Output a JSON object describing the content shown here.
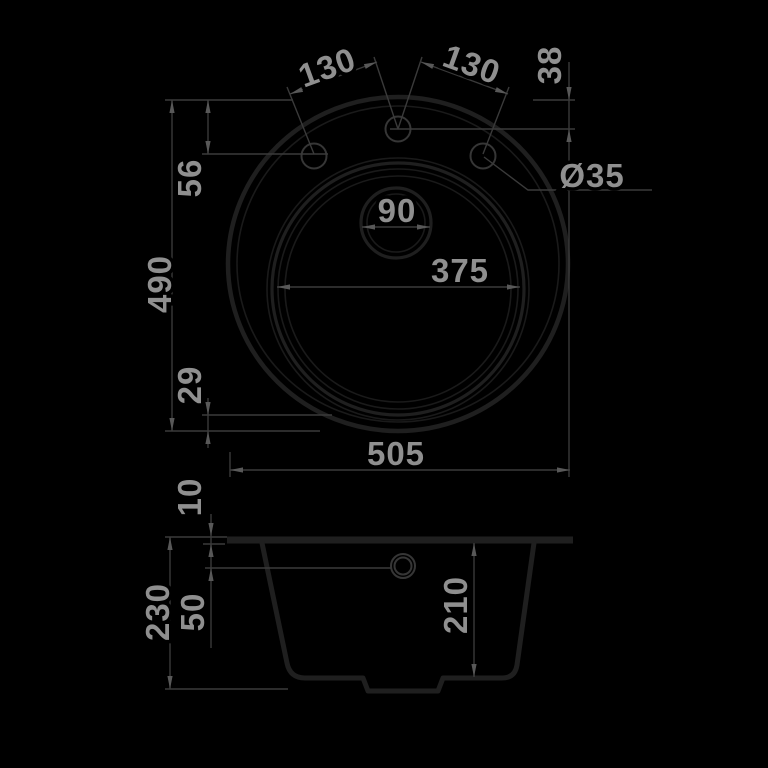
{
  "title": "Round kitchen sink dimensional drawing",
  "colors": {
    "background": "#000000",
    "outline": "#1f1f1f",
    "outline_thin": "#1a1a1a",
    "dim_line": "#3a3a3a",
    "arrow": "#585858",
    "text": "#8f8f8f"
  },
  "views": {
    "top": {
      "dims": {
        "spacing_left": "130",
        "spacing_right": "130",
        "edge_to_center_hole": "38",
        "edge_to_side_holes": "56",
        "height": "490",
        "bowl_bottom_gap": "29",
        "bowl_width": "375",
        "drain": "90",
        "hole": "Ø35",
        "width": "505"
      }
    },
    "side": {
      "dims": {
        "rim_thickness": "10",
        "overall_depth": "230",
        "rim_to_drain_line": "50",
        "bowl_depth": "210"
      }
    }
  }
}
